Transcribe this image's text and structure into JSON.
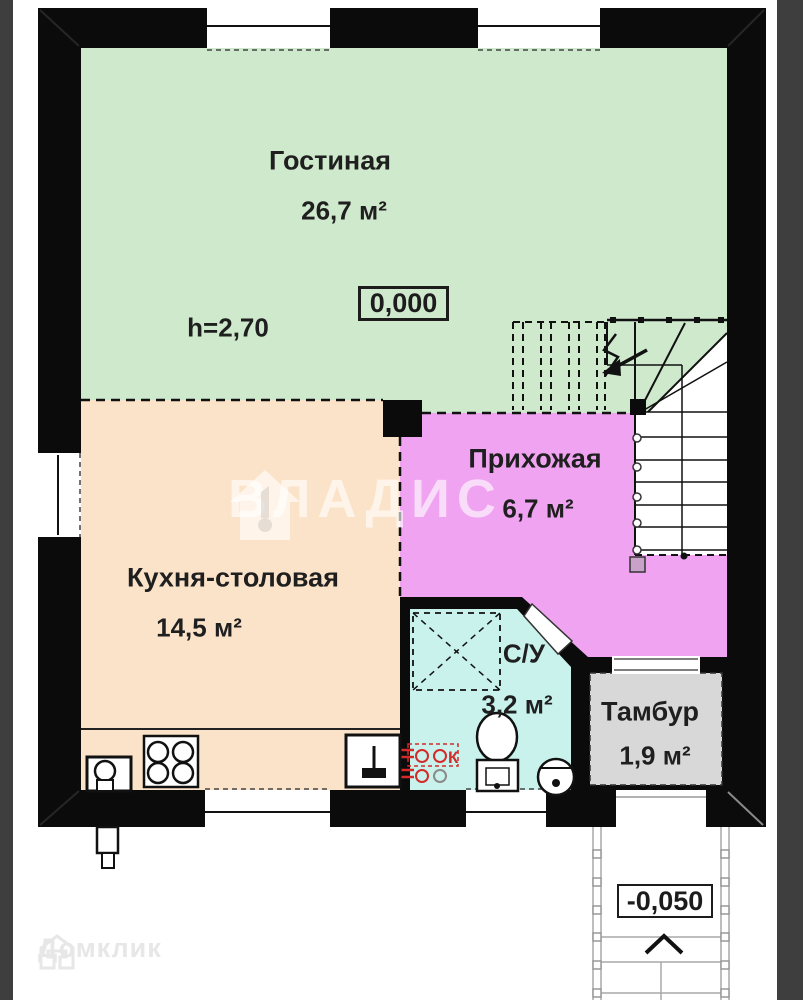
{
  "plan_title": "floor-plan-first-floor",
  "rooms": [
    {
      "id": "living",
      "name": "Гостиная",
      "area": "26,7 м²"
    },
    {
      "id": "kitchen",
      "name": "Кухня-столовая",
      "area": "14,5 м²"
    },
    {
      "id": "hallway",
      "name": "Прихожая",
      "area": "6,7 м²"
    },
    {
      "id": "bathroom",
      "name": "С/У",
      "area": "3,2 м²"
    },
    {
      "id": "vestibule",
      "name": "Тамбур",
      "area": "1,9 м²"
    }
  ],
  "annotations": {
    "ceiling_height": "h=2,70",
    "elevation_main": "0,000",
    "elevation_entrance": "-0,050",
    "riser_label": "К"
  },
  "watermarks": {
    "vladis": "ВЛАДИС",
    "domclick": "Домклик"
  },
  "colors": {
    "living_fill": "#cfe9cd",
    "kitchen_fill": "#fbe3c9",
    "hallway_fill": "#f0a3f0",
    "bathroom_fill": "#c9f2ec",
    "vestibule_fill": "#d8d8d8",
    "wall": "#0b0b0b",
    "side_strip": "#3e3e3e",
    "riser_red": "#d42a2a",
    "porch_line": "#a8a8a8"
  }
}
